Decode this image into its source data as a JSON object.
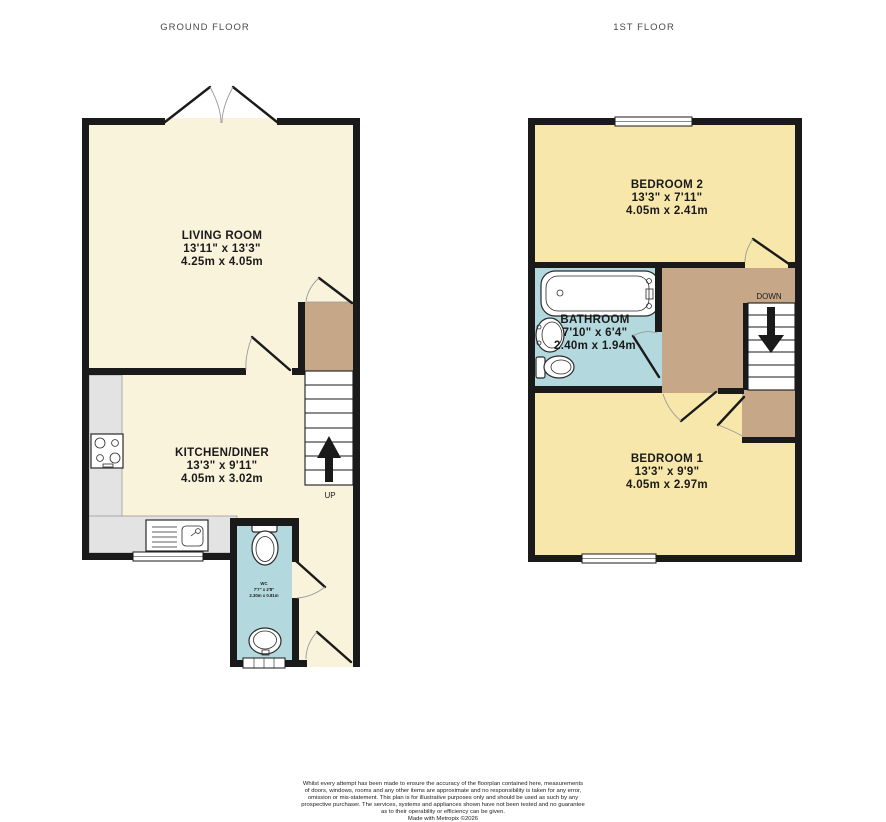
{
  "titles": {
    "ground_floor": "GROUND FLOOR",
    "first_floor": "1ST FLOOR"
  },
  "ground_floor": {
    "living_room": {
      "name": "LIVING ROOM",
      "size_imperial": "13'11\"  x 13'3\"",
      "size_metric": "4.25m  x 4.05m"
    },
    "kitchen_diner": {
      "name": "KITCHEN/DINER",
      "size_imperial": "13'3\"  x 9'11\"",
      "size_metric": "4.05m  x 3.02m"
    },
    "wc": {
      "name": "WC",
      "size_imperial": "7'7\" x 2'8\"",
      "size_metric": "2.30m x 0.81m"
    },
    "stair_label": "UP"
  },
  "first_floor": {
    "bedroom_2": {
      "name": "BEDROOM 2",
      "size_imperial": "13'3\"  x 7'11\"",
      "size_metric": "4.05m  x 2.41m"
    },
    "bathroom": {
      "name": "BATHROOM",
      "size_imperial": "7'10\"  x 6'4\"",
      "size_metric": "2.40m  x 1.94m"
    },
    "bedroom_1": {
      "name": "BEDROOM 1",
      "size_imperial": "13'3\"  x 9'9\"",
      "size_metric": "4.05m  x 2.97m"
    },
    "stair_label": "DOWN"
  },
  "footer": {
    "lines": [
      "Whilst every attempt has been made to ensure the accuracy of the floorplan contained here, measurements",
      "of doors, windows, rooms and any other items are approximate and no responsibility is taken for any error,",
      "omission or mis-statement. This plan is for illustrative purposes only and should be used as such by any",
      "prospective purchaser. The services, systems and appliances shown have not been tested and no guarantee",
      "as to their operability or efficiency can be given."
    ],
    "credit": "Made with Metropix ©2026"
  },
  "colors": {
    "room_cream": "#FAF3DC",
    "room_tan": "#F8E7AA",
    "room_blue": "#B3D9DF",
    "landing_brown": "#C6A888",
    "counter_grey": "#E3E3E3",
    "wall": "#1A1A1A"
  }
}
